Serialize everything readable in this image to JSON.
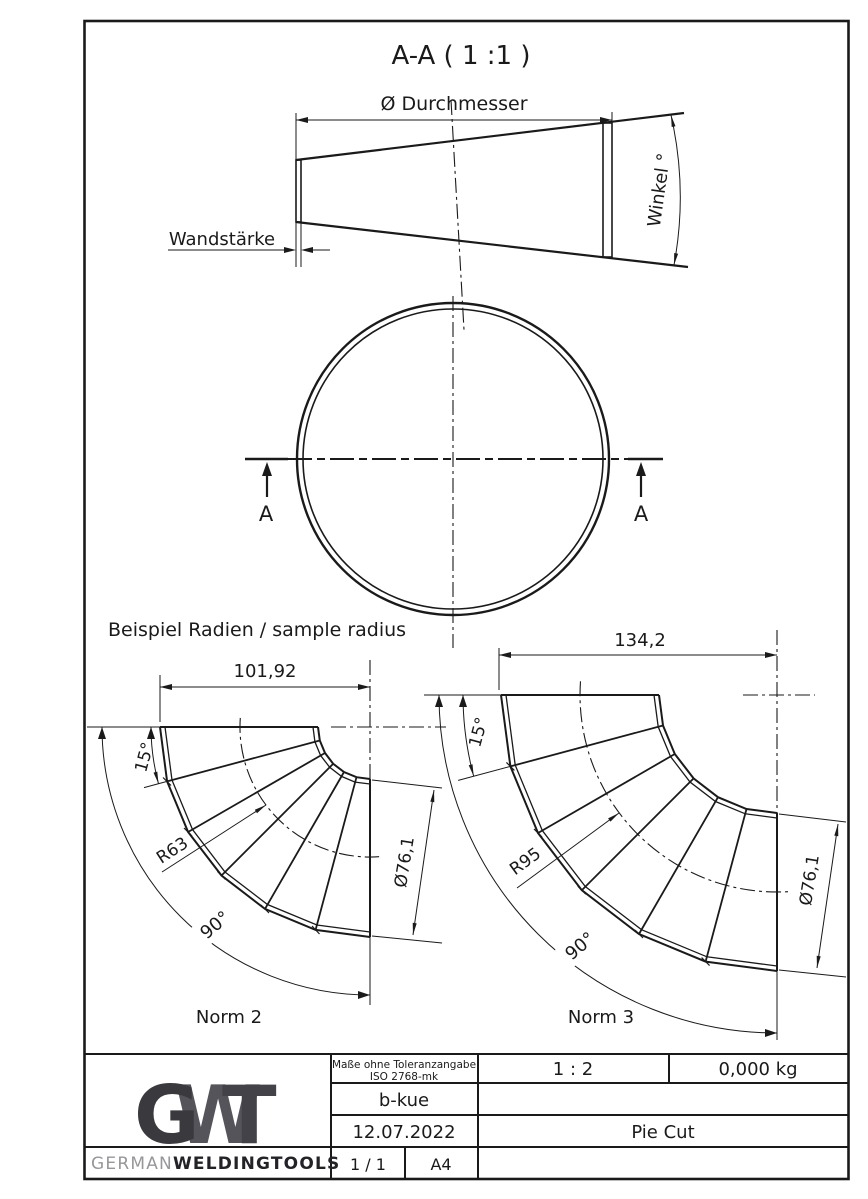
{
  "section_view": {
    "title": "A-A ( 1 :1 )",
    "diameter_label": "Ø Durchmesser",
    "wall_label": "Wandstärke",
    "angle_label": "Winkel °",
    "marker": "A"
  },
  "samples": {
    "heading": "Beispiel Radien / sample radius",
    "norm2": {
      "width": "101,92",
      "segment_angle": "15°",
      "radius": "R63",
      "diameter": "Ø76,1",
      "bend_angle": "90°",
      "caption": "Norm 2"
    },
    "norm3": {
      "width": "134,2",
      "segment_angle": "15°",
      "radius": "R95",
      "diameter": "Ø76,1",
      "bend_angle": "90°",
      "caption": "Norm 3"
    }
  },
  "title_block": {
    "tolerance_line1": "Maße ohne Toleranzangabe",
    "tolerance_line2": "ISO 2768-mk",
    "scale": "1 : 2",
    "weight": "0,000 kg",
    "created_by": "b-kue",
    "date": "12.07.2022",
    "part_name": "Pie Cut",
    "sheet": "1 / 1",
    "paper_size": "A4",
    "logo_g": "G",
    "logo_w": "W",
    "logo_t": "T",
    "brand_prefix": "GERMAN",
    "brand_suffix": "WELDINGTOOLS"
  },
  "colors": {
    "line": "#1a1a1a",
    "logo_g": "#3a393d",
    "logo_w": "#55545a",
    "logo_t": "#434248",
    "brand_gray": "#97969a",
    "brand_dark": "#232227"
  }
}
